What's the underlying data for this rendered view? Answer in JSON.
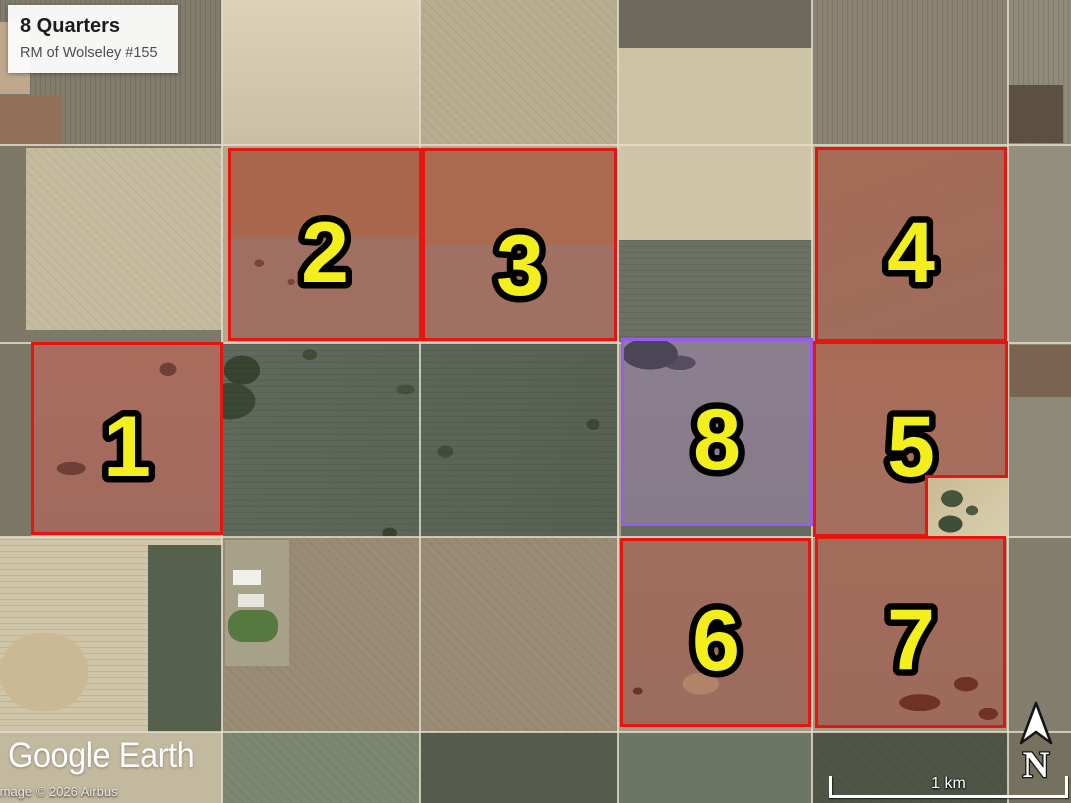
{
  "title_card": {
    "title": "8 Quarters",
    "subtitle": "RM of Wolseley #155"
  },
  "parcels": [
    {
      "number": "1",
      "outline": "red"
    },
    {
      "number": "2",
      "outline": "red"
    },
    {
      "number": "3",
      "outline": "red"
    },
    {
      "number": "4",
      "outline": "red"
    },
    {
      "number": "5",
      "outline": "red"
    },
    {
      "number": "6",
      "outline": "red"
    },
    {
      "number": "7",
      "outline": "red"
    },
    {
      "number": "8",
      "outline": "purple"
    }
  ],
  "attribution": {
    "logo": "Google Earth",
    "copyright": "Image © 2026 Airbus"
  },
  "scale_bar": {
    "label": "1 km"
  },
  "compass": {
    "label": "N"
  },
  "colors": {
    "parcel-red-border": "#e81410",
    "parcel-purple-border": "#9a5cf0",
    "label-yellow": "#f2ef1d",
    "scalebar-white": "#ffffff"
  }
}
